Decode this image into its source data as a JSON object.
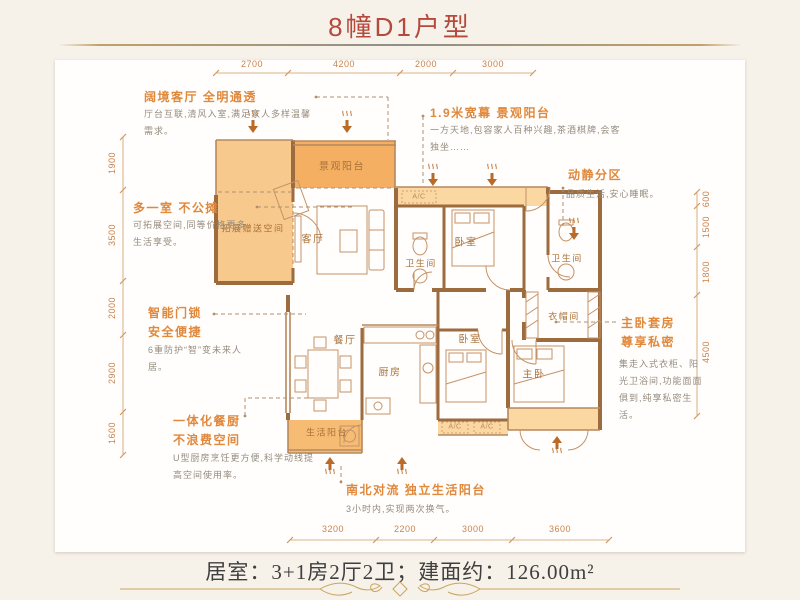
{
  "title": "8幢D1户型",
  "summary": "居室：3+1房2厅2卫；建面约：126.00m²",
  "dimensions": {
    "top": [
      "2700",
      "4200",
      "2000",
      "3000"
    ],
    "bottom": [
      "3200",
      "2200",
      "3000",
      "3600"
    ],
    "left": [
      "1900",
      "3500",
      "2000",
      "2900",
      "1600"
    ],
    "right": [
      "600",
      "1500",
      "1800",
      "4500"
    ]
  },
  "rooms": {
    "view_balcony": "景观阳台",
    "bonus_space": "拓展赠送空间",
    "living": "客厅",
    "bath1": "卫生间",
    "bed1": "卧室",
    "bath2": "卫生间",
    "cloak": "衣帽间",
    "dining": "餐厅",
    "kitchen": "厨房",
    "bed2": "卧室",
    "master": "主卧",
    "life_balcony": "生活阳台",
    "ac": "A/C"
  },
  "annotations": {
    "living": {
      "heading": "阔境客厅 全明通透",
      "body": "厅台互联,清风入室,满足家人多样温馨需求。"
    },
    "view_balcony": {
      "heading": "1.9米宽幕 景观阳台",
      "body": "一方天地,包容家人百种兴趣,茶酒棋牌,会客独坐……"
    },
    "zoning": {
      "heading": "动静分区",
      "body": "品质生活,安心睡眠。"
    },
    "bonus": {
      "heading": "多一室 不公摊",
      "body": "可拓展空间,同等价格更多生活享受。"
    },
    "smart_lock": {
      "heading": "智能门锁\n安全便捷",
      "body": "6重防护“智”变未来人居。"
    },
    "kitchen": {
      "heading": "一体化餐厨\n不浪费空间",
      "body": "U型厨房烹饪更方便,科学动线提高空间使用率。"
    },
    "ventilation": {
      "heading": "南北对流 独立生活阳台",
      "body": "3小时内,实现两次换气。"
    },
    "master": {
      "heading": "主卧套房\n尊享私密",
      "body": "集走入式衣柜、阳光卫浴间,功能面面俱到,纯享私密生活。"
    }
  },
  "colors": {
    "title_red": "#b5493c",
    "accent_orange": "#e0883b",
    "wall_brown": "#9c6b3e",
    "fill_light": "#fbd7a1",
    "fill_mid": "#f8c98c",
    "fill_deep": "#f4af62",
    "gold": "#c9a55e"
  }
}
